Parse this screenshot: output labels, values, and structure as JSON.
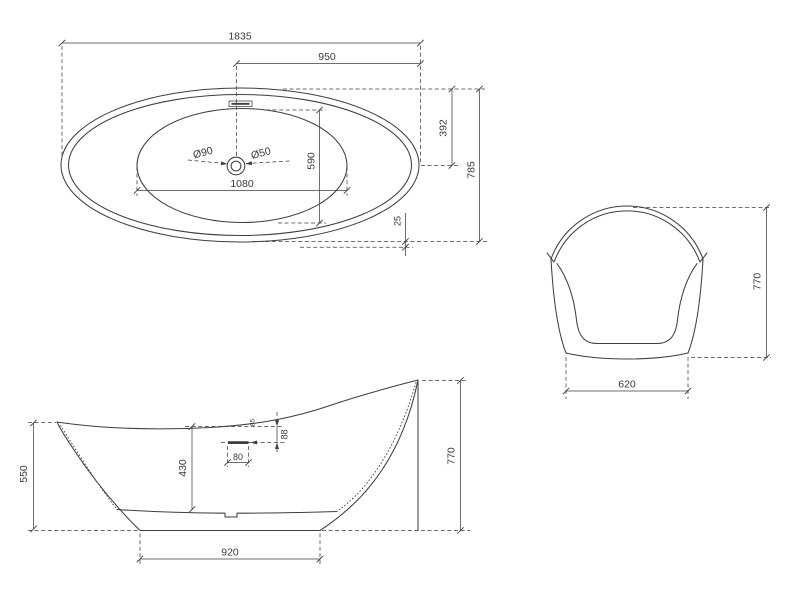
{
  "drawing": {
    "type": "bathtub-dimension-drawing",
    "views": {
      "top": {
        "overall_length": "1835",
        "center_to_right_end": "950",
        "top_edge_to_center": "392",
        "overall_width": "785",
        "basin_width": "590",
        "basin_length": "1080",
        "drain_outer_diameter": "Ø90",
        "drain_inner_diameter": "Ø50",
        "rim_edge_offset": "25"
      },
      "end": {
        "base_width": "620",
        "overall_height": "770"
      },
      "side": {
        "left_rim_height": "550",
        "basin_depth": "430",
        "overflow_horizontal": "80",
        "overflow_vertical": "88",
        "overflow_small_note": "85",
        "base_length": "920",
        "right_rim_height": "770"
      }
    },
    "colors": {
      "line": "#3f3f3f",
      "text": "#3a3a3a",
      "background": "#ffffff"
    }
  }
}
